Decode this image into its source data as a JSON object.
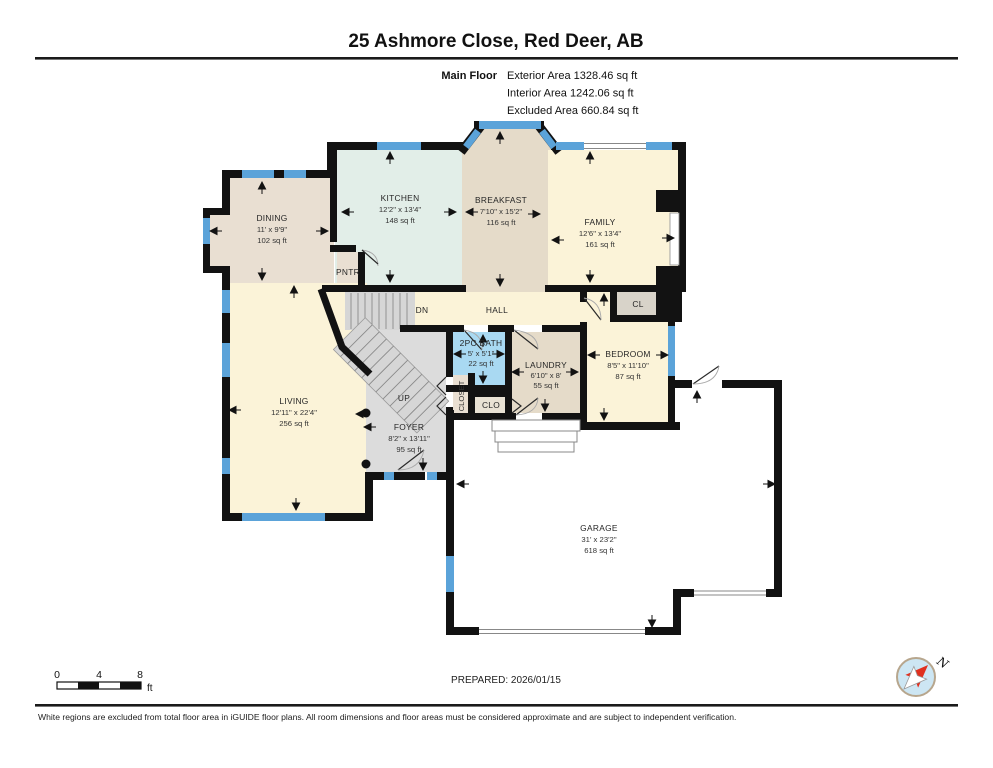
{
  "header": {
    "title": "25 Ashmore Close, Red Deer, AB",
    "floor_label": "Main Floor",
    "area_lines": [
      "Exterior Area 1328.46 sq ft",
      "Interior Area 1242.06 sq ft",
      "Excluded Area 660.84 sq ft"
    ]
  },
  "rooms": {
    "dining": {
      "name": "DINING",
      "dims": "11' x 9'9\"",
      "area": "102 sq ft"
    },
    "kitchen": {
      "name": "KITCHEN",
      "dims": "12'2\" x 13'4\"",
      "area": "148 sq ft"
    },
    "breakfast": {
      "name": "BREAKFAST",
      "dims": "7'10\" x 15'2\"",
      "area": "116 sq ft"
    },
    "family": {
      "name": "FAMILY",
      "dims": "12'6\" x 13'4\"",
      "area": "161 sq ft"
    },
    "pantry": {
      "name": "PNTR"
    },
    "hall": {
      "name": "HALL"
    },
    "stairs_dn": {
      "name": "DN"
    },
    "stairs_up": {
      "name": "UP"
    },
    "closet_cl": {
      "name": "CL"
    },
    "bath": {
      "name": "2PC BATH",
      "dims": "5' x 5'1\"",
      "area": "22 sq ft"
    },
    "laundry": {
      "name": "LAUNDRY",
      "dims": "6'10\" x 8'",
      "area": "55 sq ft"
    },
    "bedroom": {
      "name": "BEDROOM",
      "dims": "8'5\" x 11'10\"",
      "area": "87 sq ft"
    },
    "living": {
      "name": "LIVING",
      "dims": "12'11\" x 22'4\"",
      "area": "256 sq ft"
    },
    "foyer": {
      "name": "FOYER",
      "dims": "8'2\" x 13'11\"",
      "area": "95 sq ft"
    },
    "closet_hall": {
      "name": "CLOSET"
    },
    "closet_clo": {
      "name": "CLO"
    },
    "garage": {
      "name": "GARAGE",
      "dims": "31' x 23'2\"",
      "area": "618 sq ft"
    }
  },
  "scale_bar": {
    "ticks": [
      "0",
      "4",
      "8"
    ],
    "unit": "ft"
  },
  "compass": {
    "north_label": "N"
  },
  "footer": {
    "prepared": "PREPARED: 2026/01/15",
    "disclaimer": "White regions are excluded from total floor area in iGUIDE floor plans. All room dimensions and floor areas must be considered approximate and are subject to independent verification."
  },
  "colors": {
    "wall": "#121212",
    "window": "#5ba3d9",
    "room_tan": "#e9dfd2",
    "room_tan_dark": "#e5dbc9",
    "room_green": "#e2eee8",
    "room_yellow": "#fbf3d8",
    "room_blue": "#a9d9f2",
    "room_gray": "#dcdcdc",
    "closet_gray": "#d8d3c9"
  }
}
